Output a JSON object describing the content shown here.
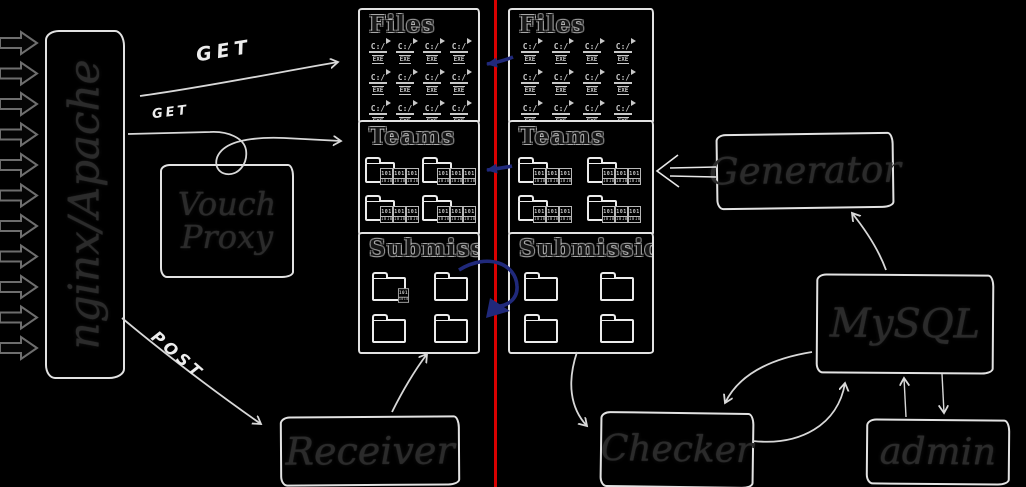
{
  "diagram": {
    "colors": {
      "background": "#000000",
      "sketch_stroke": "#e2e2e2",
      "arrow_stroke": "#d8d8d8",
      "incoming_arrow_stroke": "#6e6e6e",
      "node_text": "#2b2b2b",
      "handwritten_text": "#ededed",
      "red_divider": "#d80000",
      "blue_arrow": "#20297b"
    },
    "nodes": {
      "nginx": {
        "label": "nginx/Apache"
      },
      "vouch": {
        "label": "Vouch Proxy"
      },
      "receiver": {
        "label": "Receiver"
      },
      "generator": {
        "label": "Generator"
      },
      "mysql": {
        "label": "MySQL"
      },
      "checker": {
        "label": "Checker"
      },
      "admin": {
        "label": "admin"
      }
    },
    "edge_labels": {
      "get_files": "GET",
      "get_teams": "GET",
      "post": "POST"
    },
    "panels": {
      "left": {
        "files": {
          "title": "Files",
          "icon": "exe-file-icon",
          "icon_count": 12
        },
        "teams": {
          "title": "Teams",
          "icon": "folder-with-binaries-icon",
          "icon_count": 6
        },
        "submissions": {
          "title": "Submissio",
          "icon": "folder-icon",
          "icon_count": 6,
          "first_folder_has_binary_overlay": true
        }
      },
      "right": {
        "files": {
          "title": "Files",
          "icon": "exe-file-icon",
          "icon_count": 12
        },
        "teams": {
          "title": "Teams",
          "icon": "folder-with-binaries-icon",
          "icon_count": 6
        },
        "submissions": {
          "title": "Submissions",
          "icon": "folder-icon",
          "icon_count": 6,
          "first_folder_has_binary_overlay": false
        }
      }
    },
    "icons": {
      "exe": {
        "label_top": "C:/",
        "label_bottom": "EXE"
      },
      "binary": {
        "top": "101",
        "bottom": "1010"
      }
    },
    "incoming_arrows": {
      "count": 11
    }
  }
}
